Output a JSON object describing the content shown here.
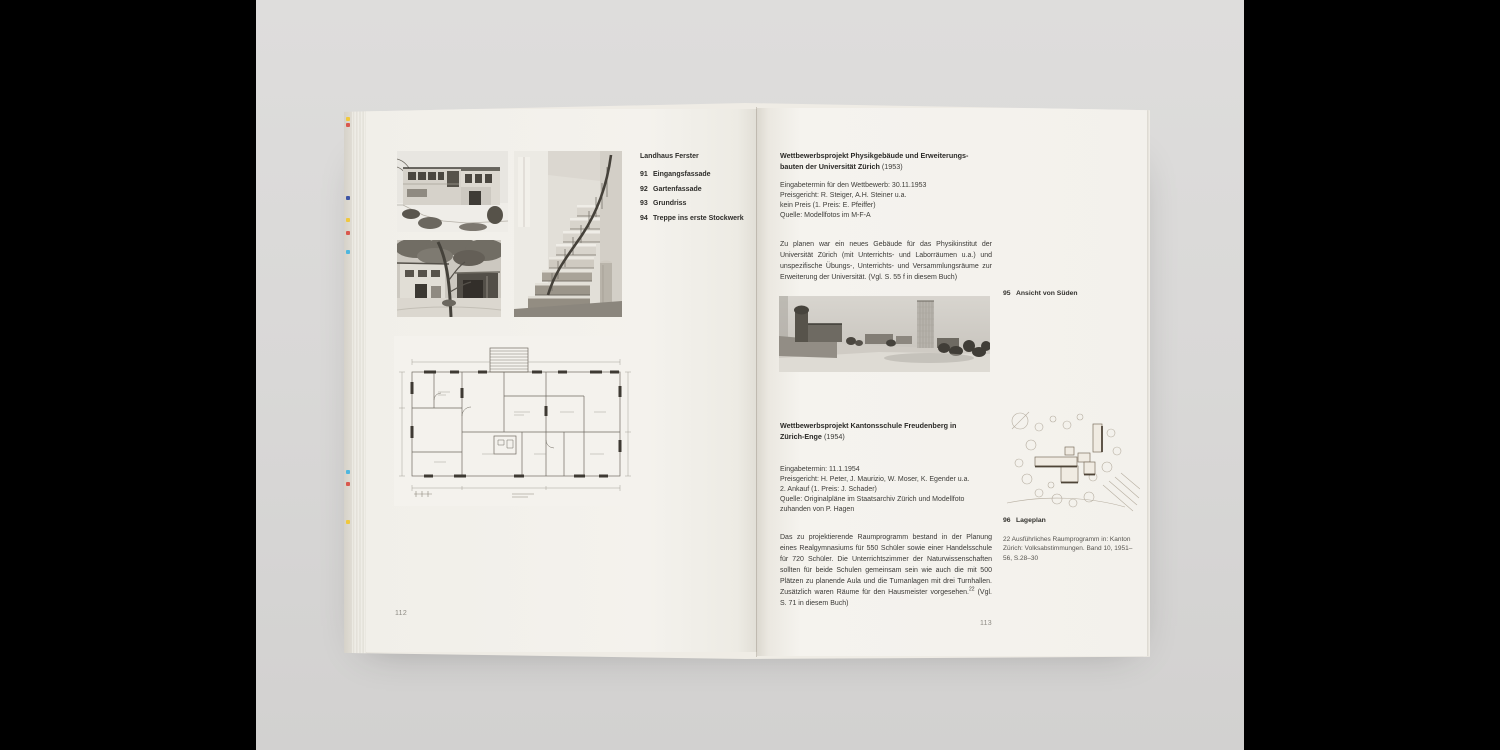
{
  "canvas": {
    "frame_color": "#000000",
    "surface_color": "#d8d7d6",
    "page_color": "#f3f1ec"
  },
  "book": {
    "print_registration_mark_colors": [
      "#f2c62e",
      "#d84a3f",
      "#2c47a0",
      "#f2c62e",
      "#d84a3f",
      "#3fb3e0",
      "#3fb3e0",
      "#d84a3f",
      "#f2c62e"
    ],
    "left_page": {
      "page_number": "112",
      "caption_block": {
        "title": "Landhaus Ferster",
        "items": [
          {
            "num": "91",
            "label": "Eingangsfassade"
          },
          {
            "num": "92",
            "label": "Gartenfassade"
          },
          {
            "num": "93",
            "label": "Grundriss"
          },
          {
            "num": "94",
            "label": "Treppe ins erste Stockwerk"
          }
        ]
      },
      "figures": [
        {
          "name": "entrance-facade-photo"
        },
        {
          "name": "garden-facade-photo"
        },
        {
          "name": "staircase-photo"
        },
        {
          "name": "floor-plan-drawing"
        }
      ]
    },
    "right_page": {
      "page_number": "113",
      "section1": {
        "title_line1": "Wettbewerbsprojekt Physikgebäude und Erweiterungs-",
        "title_line2": "bauten der Universität Zürich",
        "year": "(1953)",
        "meta": [
          "Eingabetermin für den Wettbewerb: 30.11.1953",
          "Preisgericht: R. Steiger, A.H. Steiner u.a.",
          "kein Preis (1. Preis: E. Pfeiffer)",
          "Quelle: Modellfotos im M-F-A"
        ],
        "body": "Zu planen war ein neues Gebäude für das Physikinstitut der Universität Zürich (mit Unterrichts- und Laborräumen u.a.) und unspezifische Übungs-, Unterrichts- und Versammlungsräume zur Erweiterung der Universität. (Vgl. S. 55 f in diesem Buch)",
        "figure_caption": {
          "num": "95",
          "label": "Ansicht von Süden"
        },
        "figure": {
          "name": "model-photo-view-from-south"
        }
      },
      "section2": {
        "title_line1": "Wettbewerbsprojekt Kantonsschule Freudenberg in",
        "title_line2": "Zürich-Enge",
        "year": "(1954)",
        "meta": [
          "Eingabetermin: 11.1.1954",
          "Preisgericht: H. Peter, J. Maurizio, W. Moser, K. Egender u.a.",
          "2. Ankauf (1. Preis: J. Schader)",
          "Quelle: Originalpläne im Staatsarchiv Zürich und Modellfoto zuhanden von P. Hagen"
        ],
        "body_pre": "Das zu projektierende Raumprogramm bestand in der Planung eines Realgymnasiums für 550 Schüler sowie einer Handelsschule für 720 Schüler. Die Unterrichtszimmer der Naturwissenschaften sollten für beide Schulen gemeinsam sein wie auch die mit 500 Plätzen zu planende Aula und die Turnanlagen mit drei Turnhallen. Zusätzlich waren Räume für den Hausmeister vorgesehen.",
        "body_sup": "22",
        "body_post": " (Vgl. S. 71 in diesem Buch)",
        "figure_caption": {
          "num": "96",
          "label": "Lageplan"
        },
        "figure": {
          "name": "site-plan-sketch"
        },
        "footnote": "22  Ausführliches Raumprogramm in: Kanton Zürich: Volksabstimmungen. Band 10, 1951–56, S.28–30"
      }
    }
  }
}
